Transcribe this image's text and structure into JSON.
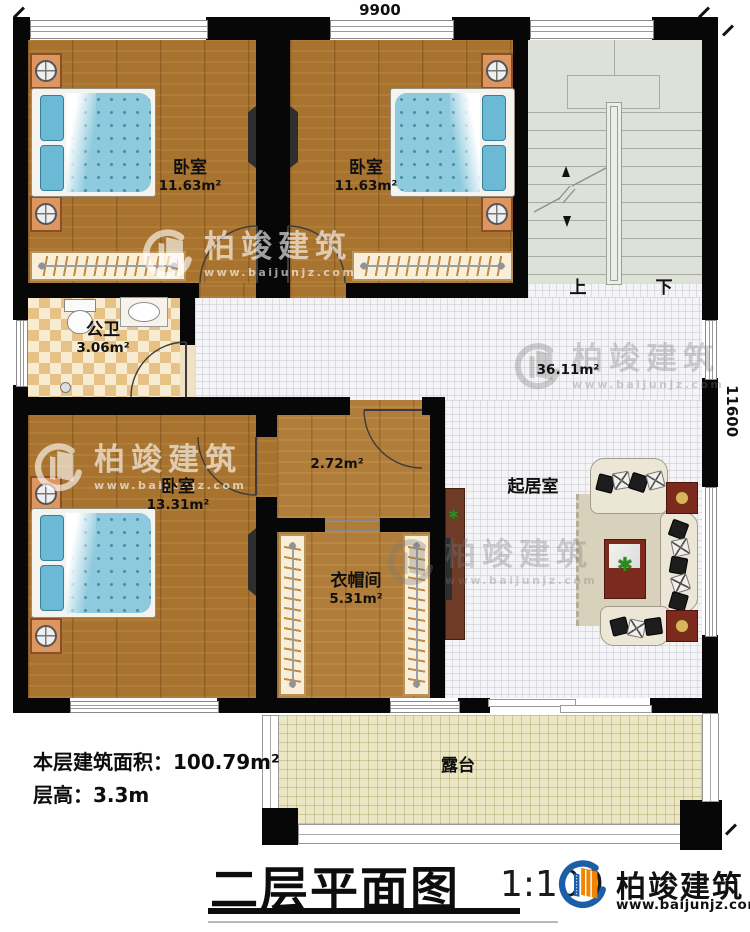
{
  "plan": {
    "dim_width": "9900",
    "dim_height": "11600",
    "rooms": {
      "bedroom1": {
        "label": "卧室",
        "area": "11.63m²"
      },
      "bedroom2": {
        "label": "卧室",
        "area": "11.63m²"
      },
      "bedroom3": {
        "label": "卧室",
        "area": "13.31m²"
      },
      "bathroom": {
        "label": "公卫",
        "area": "3.06m²"
      },
      "hallway": {
        "area": "2.72m²"
      },
      "cloakroom": {
        "label": "衣帽间",
        "area": "5.31m²"
      },
      "living": {
        "label": "起居室",
        "area": "36.11m²"
      },
      "terrace": {
        "label": "露台"
      },
      "stairs": {
        "up": "上",
        "down": "下"
      }
    }
  },
  "footer": {
    "floor_area": "本层建筑面积：100.79m²",
    "floor_height": "层高：3.3m",
    "title": "二层平面图",
    "scale": "1:100"
  },
  "brand": {
    "name": "柏竣建筑",
    "url": "www.baijunjz.com"
  },
  "watermark": {
    "name": "柏竣建筑",
    "url": "www.baijunjz.com"
  },
  "colors": {
    "wall": "#070707",
    "wood": "#a8732e",
    "brand_blue": "#1a5fa8",
    "brand_orange": "#f08300"
  }
}
